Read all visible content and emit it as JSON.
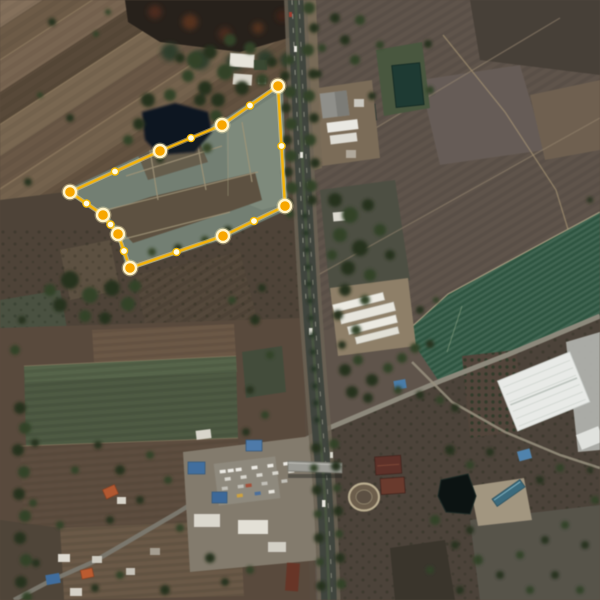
{
  "app": {
    "name": "satellite-map-view",
    "view": "aerial imagery with land-parcel polygon overlay",
    "visible_text": "none"
  },
  "map": {
    "imagery": "satellite",
    "scene": "Rural Thai farmland bisected by a tree-lined north-south highway; dry brown paddy fields upper-left, burnt dark field top-centre, factory compounds beside the road, bright green crop bands at right, truck depot, oval track, dark ponds and large white warehouse in the lower half; a gold editing polygon with vertex and midpoint handles marks a reclaimed teal-grey parcel west of the highway.",
    "parcel_overlay": {
      "shape": "polygon",
      "stroke_color": "#F6B40A",
      "glow_color": "#FFE08A",
      "fill_color": "rgba(255,215,100,0.05)",
      "stroke_width": 2.3,
      "vertices": [
        [
          278,
          86
        ],
        [
          285,
          206
        ],
        [
          223,
          236
        ],
        [
          130,
          268
        ],
        [
          118,
          234
        ],
        [
          103,
          215
        ],
        [
          70,
          192
        ],
        [
          160,
          151
        ],
        [
          222,
          125
        ]
      ],
      "vertex_style": {
        "radius": 6,
        "fill": "#F7A600",
        "ring": "#FFF3C8",
        "ring_width": 2.4
      },
      "midpoints": [
        [
          281.5,
          146
        ],
        [
          254,
          221
        ],
        [
          176.5,
          252
        ],
        [
          124,
          251
        ],
        [
          110.5,
          224.5
        ],
        [
          86.5,
          203.5
        ],
        [
          115,
          171.5
        ],
        [
          191,
          138
        ],
        [
          250,
          105.5
        ]
      ],
      "midpoint_style": {
        "radius": 3.6,
        "fill": "#FFFBE2",
        "ring": "#F2B705",
        "ring_width": 1.4
      }
    },
    "palette": {
      "field_brown": "#5f544a",
      "field_tan": "#75634d",
      "crop_green": "#2d5640",
      "parcel_terrain": "#6f7d73",
      "water_dark": "#111921",
      "road_asphalt": "#40453e",
      "roof_white": "#e8eae7",
      "roof_blue": "#3f6ea1",
      "roof_orange": "#b5572e",
      "tree_green": "#2f4026"
    }
  }
}
